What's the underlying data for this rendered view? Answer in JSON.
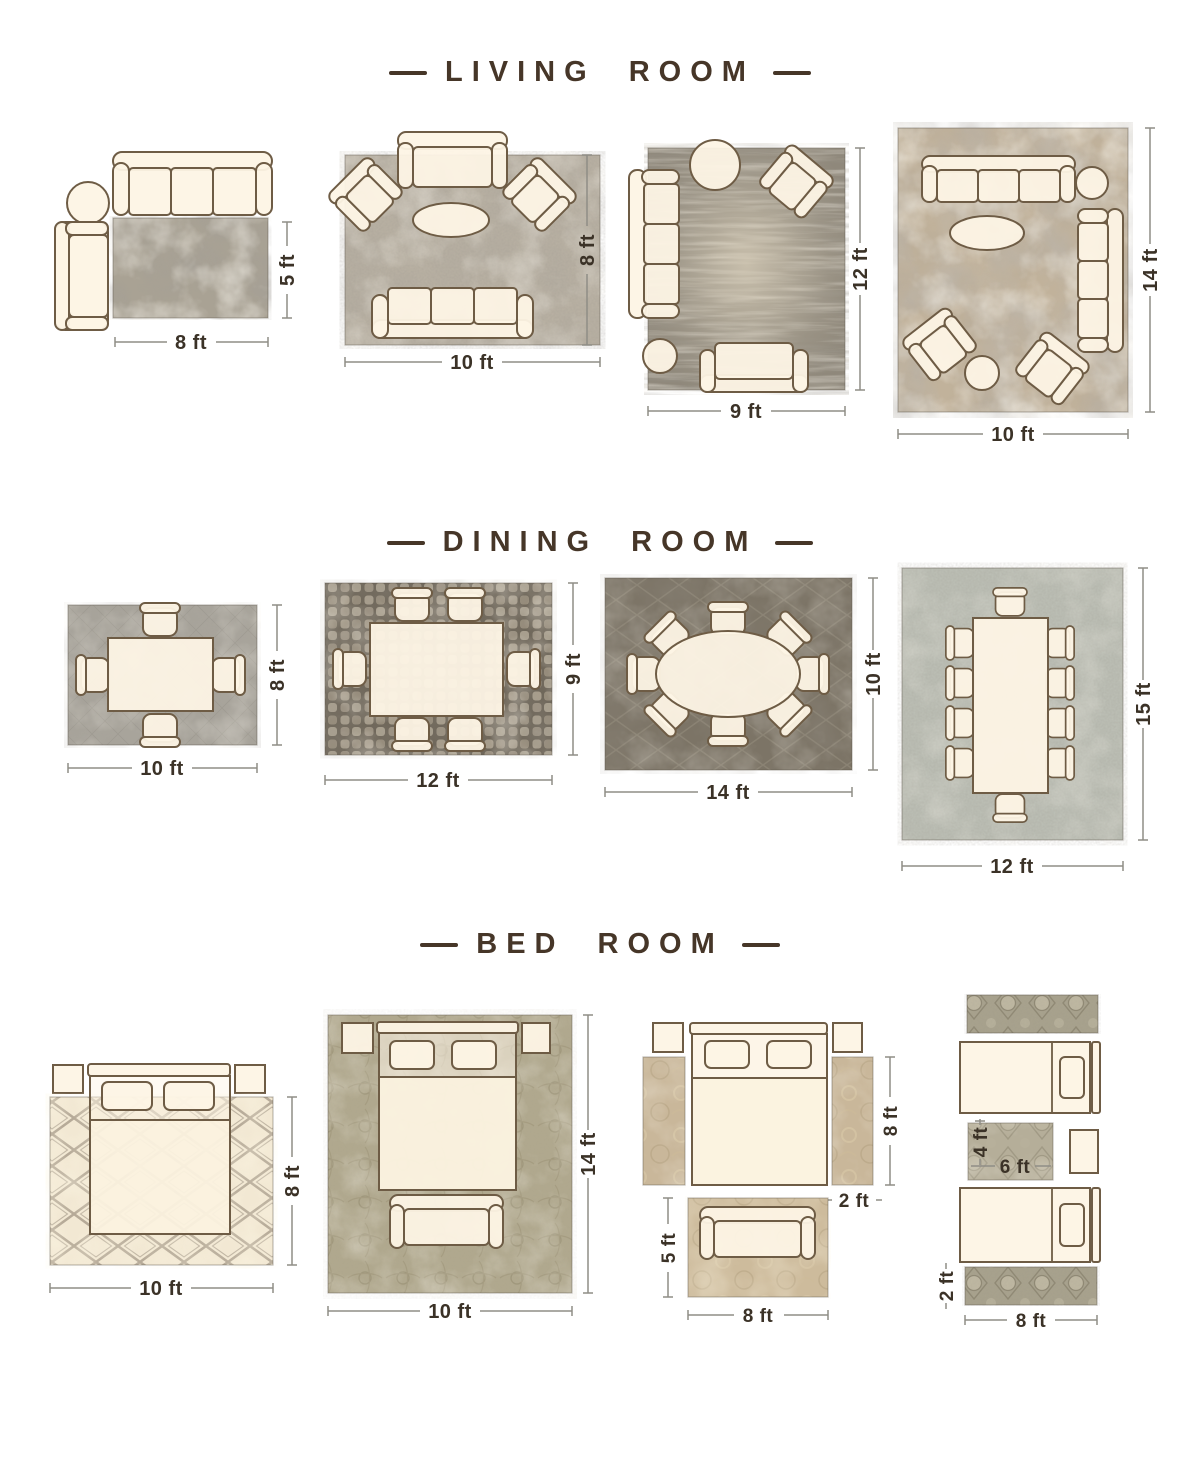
{
  "page": {
    "background": "#ffffff",
    "unit": "ft",
    "colors": {
      "title": "#463628",
      "dimension_label": "#3b3227",
      "dimension_line": "#8f8d86",
      "furniture_fill": "#fdf4e5",
      "furniture_stroke": "#6e5c45"
    }
  },
  "sections": [
    {
      "title": "LIVING ROOM",
      "layouts": [
        {
          "name": "sofa-chaise-rug-8x5",
          "rug_size": "8 ft x 5 ft",
          "rug_style": "abstract gray-taupe",
          "furniture": [
            "3-seat sofa",
            "round side table",
            "chaise"
          ],
          "labels": {
            "width": "8 ft",
            "height": "5 ft"
          }
        },
        {
          "name": "settee-two-chairs-sofa-10x8",
          "rug_size": "10 ft x 8 ft",
          "rug_style": "textured light gray",
          "furniture": [
            "settee",
            "2 angled armchairs",
            "oval coffee table",
            "3-seat sofa"
          ],
          "labels": {
            "width": "10 ft",
            "height": "8 ft"
          }
        },
        {
          "name": "sofa-armchair-loveseat-9x12",
          "rug_size": "9 ft x 12 ft",
          "rug_style": "distressed vintage gray",
          "furniture": [
            "round table",
            "angled armchair",
            "3-seat sofa",
            "round side table",
            "loveseat"
          ],
          "labels": {
            "width": "9 ft",
            "height": "12 ft"
          }
        },
        {
          "name": "two-sofas-two-chairs-10x14",
          "rug_size": "10 ft x 14 ft",
          "rug_style": "abstract beige-gray marble",
          "furniture": [
            "3-seat sofa",
            "round side table",
            "3-seat sofa",
            "oval coffee table",
            "2 angled armchairs",
            "round table"
          ],
          "labels": {
            "width": "10 ft",
            "height": "14 ft"
          }
        }
      ]
    },
    {
      "title": "DINING ROOM",
      "layouts": [
        {
          "name": "table-4-chairs-10x8",
          "rug_size": "10 ft x 8 ft",
          "rug_style": "woven gray",
          "furniture": [
            "dining table",
            "4 chairs"
          ],
          "labels": {
            "width": "10 ft",
            "height": "8 ft"
          }
        },
        {
          "name": "table-6-chairs-12x9",
          "rug_size": "12 ft x 9 ft",
          "rug_style": "pebble mosaic",
          "furniture": [
            "dining table",
            "6 chairs"
          ],
          "labels": {
            "width": "12 ft",
            "height": "9 ft"
          }
        },
        {
          "name": "oval-table-8-chairs-14x10",
          "rug_size": "14 ft x 10 ft",
          "rug_style": "dark trellis",
          "furniture": [
            "oval dining table",
            "8 chairs"
          ],
          "labels": {
            "width": "14 ft",
            "height": "10 ft"
          }
        },
        {
          "name": "long-table-10-chairs-12x15",
          "rug_size": "12 ft x 15 ft",
          "rug_style": "light speckled weave",
          "furniture": [
            "long dining table",
            "10 chairs"
          ],
          "labels": {
            "width": "12 ft",
            "height": "15 ft"
          }
        }
      ]
    },
    {
      "title": "BED ROOM",
      "layouts": [
        {
          "name": "bed-front-on-rug-10x8",
          "rug_size": "10 ft x 8 ft",
          "rug_style": "cream moroccan lattice",
          "furniture": [
            "queen bed",
            "2 nightstands"
          ],
          "labels": {
            "width": "10 ft",
            "height": "8 ft"
          }
        },
        {
          "name": "all-on-rug-with-bench-10x14",
          "rug_size": "10 ft x 14 ft",
          "rug_style": "sage damask",
          "furniture": [
            "queen bed",
            "2 nightstands",
            "bench"
          ],
          "labels": {
            "width": "10 ft",
            "height": "14 ft"
          }
        },
        {
          "name": "side-runners-and-foot-rug",
          "rug_size": "two 2 ft x 8 ft runners + 8 ft x 5 ft rug",
          "rug_style": "vintage tan floral",
          "furniture": [
            "queen bed",
            "2 nightstands",
            "bench"
          ],
          "labels": {
            "runner_height": "8 ft",
            "runner_width": "2 ft",
            "foot_rug_height": "5 ft",
            "foot_rug_width": "8 ft"
          }
        },
        {
          "name": "twin-beds-runners-accent",
          "rug_size": "two 8 ft x 2 ft runners + 6 ft x 4 ft rug",
          "rug_style": "ornate gray medallion",
          "furniture": [
            "2 twin beds",
            "nightstand"
          ],
          "labels": {
            "between_rug_height": "4 ft",
            "between_rug_width": "6 ft",
            "runner_width": "2 ft",
            "runner_length": "8 ft"
          }
        }
      ]
    }
  ]
}
